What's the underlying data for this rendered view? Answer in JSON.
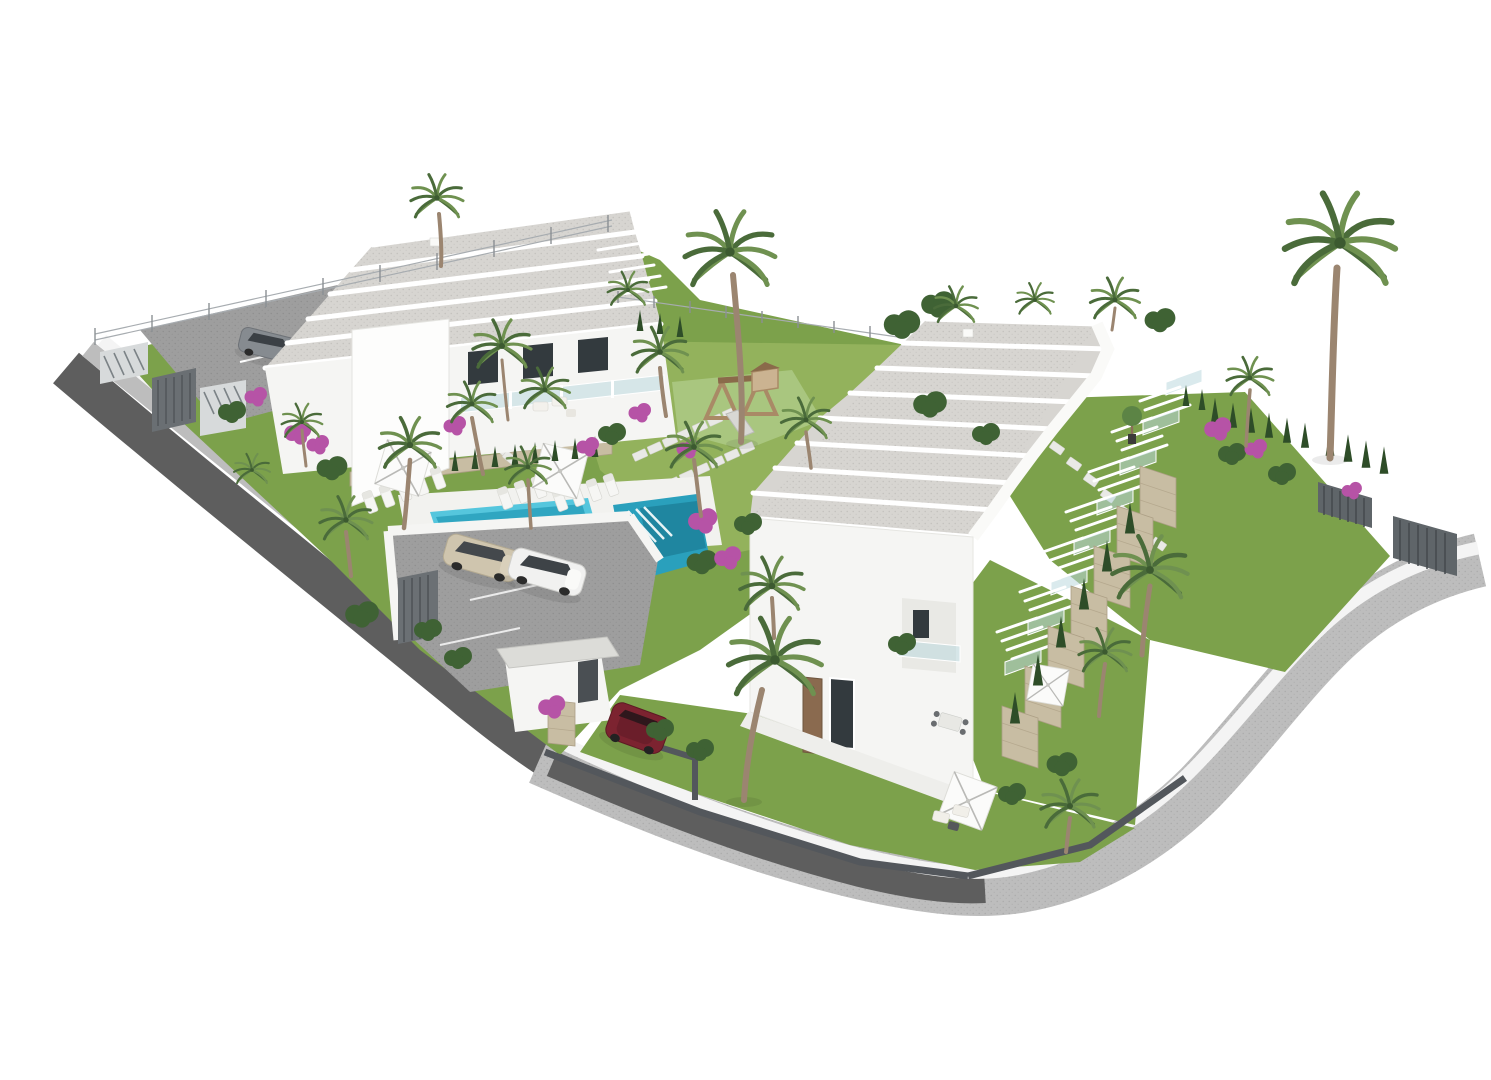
{
  "scene": {
    "type": "architectural-3d-render",
    "view": "aerial-isometric",
    "setting": "white-background site visualization of a terraced residential development with communal gardens",
    "buildings": [
      {
        "id": "left-block",
        "name": "terraced block A",
        "visible_roof_slabs": 4,
        "floors_visible": 2,
        "features": [
          "flat gravel roofs",
          "glass balconies",
          "roof pergola",
          "white render walls"
        ]
      },
      {
        "id": "right-block",
        "name": "terraced block B",
        "visible_roof_slabs": 8,
        "floors_visible": 2,
        "features": [
          "stepped gravel roofs",
          "glass balconies",
          "pergola roof terraces",
          "stone-clad terrace walls",
          "white render walls"
        ]
      }
    ],
    "amenities": {
      "swimming_pool_sections": 2,
      "pool_has_steps": true,
      "playground": {
        "present": true,
        "equipment": "wooden slide tower on green safety mat"
      },
      "parasols": 4,
      "sun_loungers": 12,
      "outdoor_seating_sets": 3,
      "stepping_stone_paths": 4
    },
    "vehicles": [
      {
        "type": "sedan",
        "color_name": "beige",
        "color": "#cfc5ae",
        "location": "lower parking court"
      },
      {
        "type": "sedan",
        "color_name": "white",
        "color": "#f1f1f0",
        "location": "lower parking court"
      },
      {
        "type": "hatchback",
        "color_name": "gray",
        "color": "#868b90",
        "location": "upper parking strip"
      },
      {
        "type": "hatchback",
        "color_name": "dark-red",
        "color": "#7c2330",
        "location": "street entrance gate"
      }
    ],
    "vegetation": {
      "palm_trees": "numerous, including two tall feature palms",
      "cypress_hedges": true,
      "bougainvillea_color": "#b653a6",
      "lawns": true
    },
    "infrastructure": {
      "perimeter": "white rendered walls with dark metal picket fencing",
      "roads": "curving asphalt street with light gray pavement band",
      "gates": [
        "upper parking slatted gate",
        "pedestrian canopy entrance",
        "vertical-bar vehicle gate"
      ]
    }
  },
  "palette": {
    "bg": "#ffffff",
    "wall": "#f5f5f3",
    "wall_shade": "#e3e3e0",
    "roof": "#d7d5d1",
    "roof_edge": "#ffffff",
    "glass": "#bcd8de",
    "lawn": "#7ca14b",
    "lawn_light": "#93b25c",
    "mat": "#a9c67f",
    "frond_dark": "#4a6b3a",
    "frond_light": "#6f9150",
    "foliage": "#3f6234",
    "foliage_light": "#5c8445",
    "trunk": "#9b8570",
    "cypress": "#2e4d28",
    "magenta": "#b653a6",
    "magenta_light": "#cd77c0",
    "pool_light": "#55c6dd",
    "pool_mid": "#2aa0bc",
    "pool_deep": "#1d7f99",
    "deck": "#f2f2ef",
    "asphalt": "#5e5e5e",
    "sidewalk": "#bdbdbd",
    "curb": "#f4f4f4",
    "parking": "#9e9e9e",
    "stone": "#c8bda3",
    "stone_dark": "#ac9f85",
    "fence": "#53575c",
    "fence_light": "#8b9094",
    "umbrella": "#fbfbfa",
    "umbrella_line": "#b9b9b6",
    "furn": "#eceae6",
    "car_beige": "#cfc5ae",
    "car_white": "#f1f1f0",
    "car_gray": "#868b90",
    "car_red": "#7c2330"
  }
}
